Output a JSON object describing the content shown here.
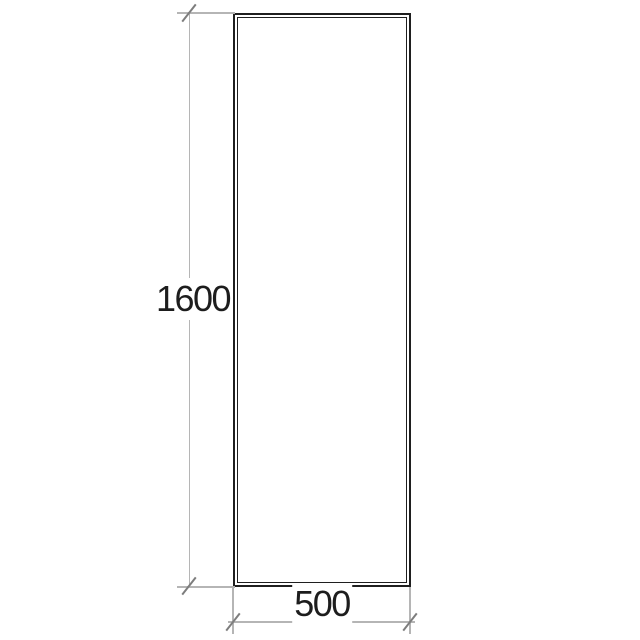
{
  "drawing": {
    "height_dimension": {
      "label": "1600"
    },
    "width_dimension": {
      "label": "500"
    }
  },
  "colors": {
    "background": "#ffffff",
    "panel_outline": "#1f1f1f",
    "dimension_line": "#b5b5b5",
    "tick_mark": "#7d7d7d",
    "label_text": "#1d1d1d"
  }
}
